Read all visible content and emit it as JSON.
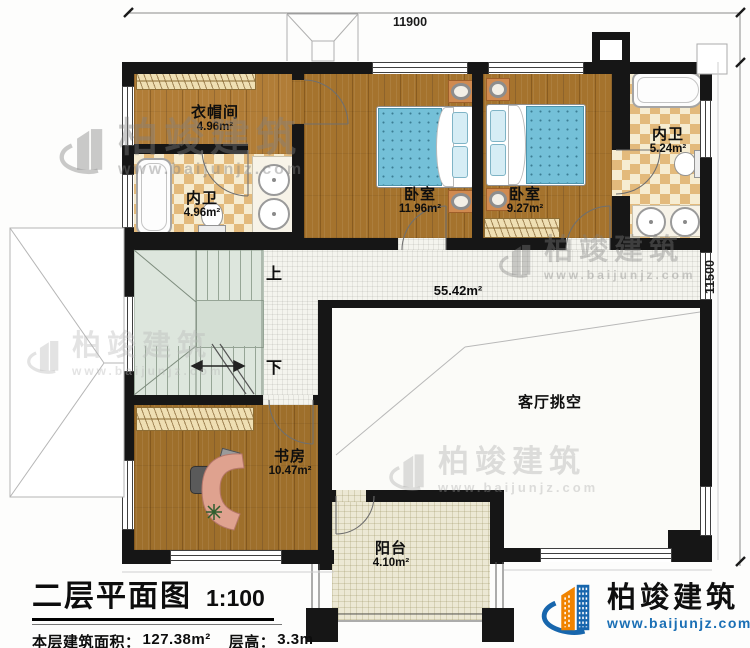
{
  "dimensions": {
    "top": "11900",
    "right": "11500"
  },
  "rooms": [
    {
      "name": "衣帽间",
      "area": "4.96m²"
    },
    {
      "name": "内卫",
      "area": "4.96m²"
    },
    {
      "name": "卧室",
      "area": "11.96m²"
    },
    {
      "name": "卧室",
      "area": "9.27m²"
    },
    {
      "name": "内卫",
      "area": "5.24m²"
    },
    {
      "name": "客厅挑空",
      "area": ""
    },
    {
      "name": "书房",
      "area": "10.47m²"
    },
    {
      "name": "阳台",
      "area": "4.10m²"
    }
  ],
  "hall_area": "55.42m²",
  "stairs": {
    "up": "上",
    "down": "下"
  },
  "title_block": {
    "title": "二层平面图",
    "scale": "1:100",
    "floor_area_label": "本层建筑面积：",
    "floor_area_value": "127.38m²",
    "floor_height_label": "层高：",
    "floor_height_value": "3.3m"
  },
  "branding": {
    "name": "柏竣建筑",
    "website": "www.baijunjz.com"
  },
  "colors": {
    "wall": "#161616",
    "wood": "#a5732d",
    "checker": "#e3ba7c",
    "stair": "#dde6dd",
    "balcony_tile": "#ece8d4",
    "bed": "#74c0d8",
    "logo_blue": "#1766ad",
    "logo_orange": "#f08300"
  }
}
